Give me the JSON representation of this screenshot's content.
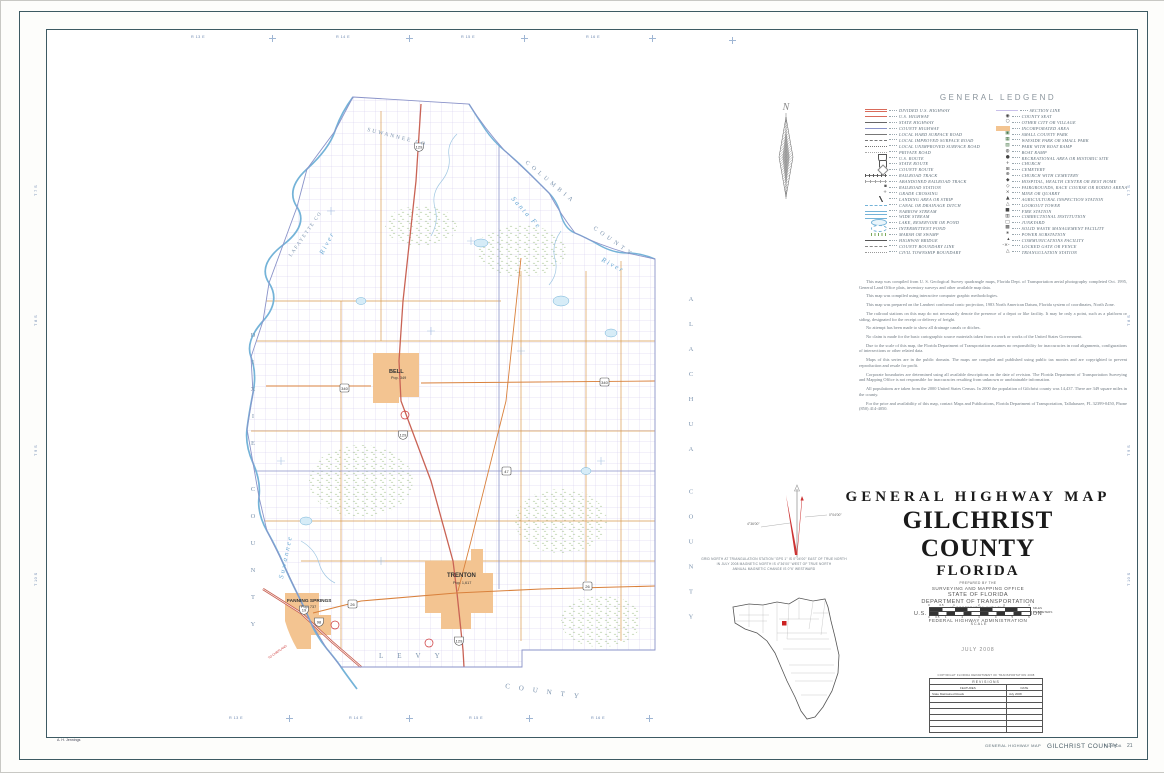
{
  "page": {
    "credit": "A. H. Jennings",
    "footer": {
      "series": "GENERAL HIGHWAY MAP",
      "county": "GILCHRIST COUNTY",
      "state": "FLORIDA",
      "page": "21"
    }
  },
  "colors": {
    "border": "#3d5a63",
    "incorporated": "#f3c491",
    "water": "#74b3d8",
    "us_highway": "#c96355",
    "state_road": "#d9813c"
  },
  "compass": {
    "letter": "N"
  },
  "legend": {
    "title": "GENERAL LEDGEND",
    "left": [
      {
        "label": "DIVIDED U.S. HIGHWAY",
        "sym": "divided"
      },
      {
        "label": "U.S. HIGHWAY",
        "sym": "us"
      },
      {
        "label": "STATE HIGHWAY",
        "sym": "state"
      },
      {
        "label": "COUNTY HIGHWAY",
        "sym": "county"
      },
      {
        "label": "LOCAL HARD SURFACE ROAD",
        "sym": "hard"
      },
      {
        "label": "LOCAL IMPROVED SURFACE ROAD",
        "sym": "improved"
      },
      {
        "label": "LOCAL UNIMPROVED SURFACE ROAD",
        "sym": "unimproved"
      },
      {
        "label": "PRIVATE ROAD",
        "sym": "private"
      },
      {
        "label": "U.S. ROUTE",
        "sym": "usroute"
      },
      {
        "label": "STATE ROUTE",
        "sym": "srroute"
      },
      {
        "label": "COUNTY ROUTE",
        "sym": "croute"
      },
      {
        "label": "RAILROAD TRACK",
        "sym": "rr"
      },
      {
        "label": "ABANDONED RAILROAD TRACK",
        "sym": "rrab"
      },
      {
        "label": "RAILROAD STATION",
        "icon": "▪",
        "color": "#555"
      },
      {
        "label": "GRADE CROSSING",
        "icon": "+",
        "color": "#555"
      },
      {
        "label": "LANDING AREA OR STRIP",
        "sym": "landing"
      },
      {
        "label": "CANAL OR DRAINAGE DITCH",
        "sym": "canal"
      },
      {
        "label": "NARROW STREAM",
        "sym": "stream"
      },
      {
        "label": "WIDE STREAM",
        "sym": "wide"
      },
      {
        "label": "LAKE, RESERVOIR OR POND",
        "sym": "lake"
      },
      {
        "label": "INTERMITTENT POND",
        "sym": "ipond"
      },
      {
        "label": "MARSH OR SWAMP",
        "sym": "marsh"
      },
      {
        "label": "HIGHWAY BRIDGE",
        "sym": "bridge"
      },
      {
        "label": "COUNTY BOUNDARY LINE",
        "sym": "cobound"
      },
      {
        "label": "CIVIL TOWNSHIP BOUNDARY",
        "sym": "township"
      }
    ],
    "right": [
      {
        "label": "SECTION LINE",
        "sym": "section"
      },
      {
        "label": "COUNTY SEAT",
        "icon": "◉",
        "color": "#444"
      },
      {
        "label": "OTHER CITY OR VILLAGE",
        "icon": "○",
        "color": "#444"
      },
      {
        "label": "INCORPORATED AREA",
        "sym": "inc"
      },
      {
        "label": "SMALL COUNTY PARK",
        "icon": "▣",
        "color": "#4a7a4a"
      },
      {
        "label": "WAYSIDE PARK OR SMALL PARK",
        "icon": "▦",
        "color": "#4a7a4a"
      },
      {
        "label": "PARK WITH BOAT RAMP",
        "icon": "▨",
        "color": "#4a7a4a"
      },
      {
        "label": "BOAT RAMP",
        "icon": "◍",
        "color": "#444"
      },
      {
        "label": "RECREATIONAL AREA OR HISTORIC SITE",
        "icon": "●",
        "color": "#444"
      },
      {
        "label": "CHURCH",
        "icon": "+",
        "color": "#444"
      },
      {
        "label": "CEMETERY",
        "icon": "⊞",
        "color": "#444"
      },
      {
        "label": "CHURCH WITH CEMETERY",
        "icon": "⊕",
        "color": "#444"
      },
      {
        "label": "HOSPITAL, HEALTH CENTER OR REST HOME",
        "icon": "◆",
        "color": "#444"
      },
      {
        "label": "FAIRGROUNDS, RACE COURSE OR RODEO ARENA",
        "icon": "◇",
        "color": "#444"
      },
      {
        "label": "MINE OR QUARRY",
        "icon": "×",
        "color": "#444"
      },
      {
        "label": "AGRICULTURAL INSPECTION STATION",
        "icon": "▲",
        "color": "#444"
      },
      {
        "label": "LOOKOUT TOWER",
        "icon": "△",
        "color": "#444"
      },
      {
        "label": "FIRE STATION",
        "icon": "■",
        "color": "#444"
      },
      {
        "label": "CORRECTIONAL INSTITUTION",
        "icon": "▥",
        "color": "#444"
      },
      {
        "label": "JUNKYARD",
        "icon": "□",
        "color": "#444"
      },
      {
        "label": "SOLID WASTE MANAGEMENT FACILITY",
        "icon": "▩",
        "color": "#444"
      },
      {
        "label": "POWER SUBSTATION",
        "icon": "∗",
        "color": "#444"
      },
      {
        "label": "COMMUNICATIONS FACILITY",
        "icon": "▴",
        "color": "#444"
      },
      {
        "label": "LOCKED GATE OR FENCE",
        "icon": "-×-",
        "color": "#444"
      },
      {
        "label": "TRIANGULATION STATION",
        "icon": "△",
        "color": "#444"
      }
    ]
  },
  "notes": [
    "This map was compiled from U. S. Geological Survey quadrangle maps, Florida Dept. of Transportation aerial photography completed Oct. 1995, General Land Office plats, inventory surveys and other available map data.",
    "This map was compiled using interactive computer graphic methodologies.",
    "This map was prepared on the Lambert conformal conic projection, 1983 North American Datum, Florida system of coordinates, North Zone.",
    "The railroad stations on this map do not necessarily denote the presence of a depot or like facility. It may be only a point, such as a platform or siding, designated for the receipt or delivery of freight.",
    "No attempt has been made to show all drainage canals or ditches.",
    "No claim is made for the basic cartographic source materials taken from a work or works of the United States Government.",
    "Due to the scale of this map, the Florida Department of Transportation assumes no responsibility for inaccuracies in road alignments, configurations of intersections or other related data.",
    "Maps of this series are in the public domain. The maps are compiled and published using public tax monies and are copyrighted to prevent reproduction and resale for profit.",
    "Corporate boundaries are determined using all available descriptions on the date of revision. The Florida Department of Transportation Surveying and Mapping Office is not responsible for inaccuracies resulting from unknown or unobtainable information.",
    "All populations are taken from the 2000 United States Census. In 2000 the population of Gilchrist county was 14,437. There are 349 square miles in the county.",
    "For the price and availability of this map, contact Maps and Publications, Florida Department of Transportation, Tallahassee, FL 32399-0450, Phone (850) 414-4050."
  ],
  "declination": {
    "left_label": "4°36'00\"",
    "right_label": "0°04'00\"",
    "caption": [
      "GRID NORTH AT TRIANGULATION STATION \"GPS 1\" IS 0°04'00\" EAST OF TRUE NORTH",
      "IN JULY 2008 MAGNETIC NORTH IS 4°36'00\" WEST OF TRUE NORTH",
      "ANNUAL MAGNETIC CHANGE IS 0°6' WESTWARD"
    ]
  },
  "title_block": {
    "line1": "GENERAL HIGHWAY MAP",
    "line2": "GILCHRIST COUNTY",
    "line3": "FLORIDA",
    "sub": [
      "PREPARED BY THE",
      "SURVEYING AND MAPPING OFFICE",
      "STATE OF FLORIDA",
      "DEPARTMENT OF TRANSPORTATION",
      "IN COOPERATION WITH THE",
      "U.S. DEPARTMENT OF TRANSPORTATION",
      "FEDERAL HIGHWAY ADMINISTRATION"
    ]
  },
  "scale": {
    "miles_ticks": [
      "0",
      "0.5",
      "1",
      "2",
      "3",
      "4"
    ],
    "km_ticks": [
      "0",
      "0.5",
      "1",
      "2",
      "3",
      "4",
      "5",
      "6"
    ],
    "miles_label": "MILES",
    "km_label": "KILOMETERS",
    "label": "SCALE"
  },
  "date": "JULY 2008",
  "revisions": {
    "copyright": "COPYRIGHT FLORIDA DEPARTMENT OF TRANSPORTATION 2008",
    "title": "REVISIONS",
    "col_features": "FEATURES",
    "col_date": "DATE",
    "rows": [
      {
        "features": "State Maintained Roads",
        "date": "July 2008"
      }
    ],
    "empty_rows": 6
  },
  "map": {
    "towns": [
      {
        "name": "BELL",
        "pop": "Pop. 349"
      },
      {
        "name": "TRENTON",
        "pop": "Pop. 1,617"
      },
      {
        "name": "FANNING SPRINGS",
        "pop": "Pop. 737"
      }
    ],
    "counties": {
      "suwannee": "SUWANNEE CO",
      "columbia": "COLUMBIA",
      "columbia2": "COUNTY",
      "lafayette": "LAFAYETTE CO",
      "dixie": "DIXIE COUNTY",
      "alachua": "ALACHUA COUNTY",
      "levy": "LEVY",
      "levy2": "COUNTY"
    },
    "rivers": {
      "santa_fe": "Santa Fe",
      "santa_fe2": "River",
      "suwannee": "Suwannee",
      "suwannee2": "River"
    },
    "routes": [
      "129",
      "340",
      "47",
      "26",
      "19",
      "98"
    ],
    "to_labels": [
      "TO CHIEFLAND"
    ],
    "range_top": [
      "R 13 E",
      "R 14 E",
      "R 15 E",
      "R 16 E"
    ],
    "range_bottom": [
      "R 13 E",
      "R 14 E",
      "R 15 E",
      "R 16 E"
    ],
    "township_left": [
      "T 7 S",
      "T 8 S",
      "T 9 S",
      "T 10 S"
    ],
    "township_right": [
      "T 7 S",
      "T 8 S",
      "T 9 S",
      "T 10 S"
    ]
  }
}
